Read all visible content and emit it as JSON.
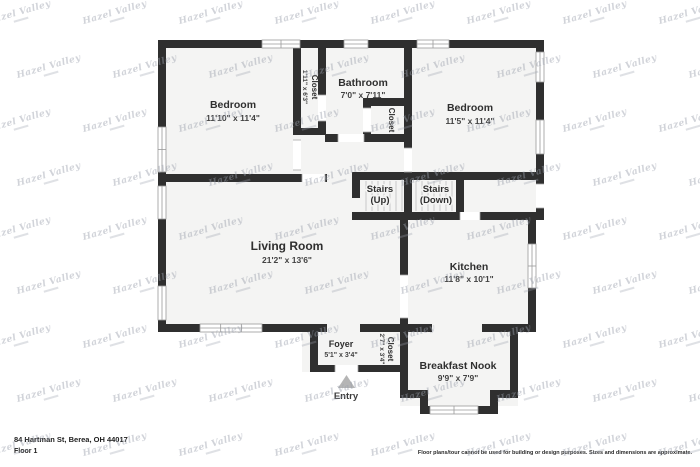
{
  "meta": {
    "watermark": "Hazel Valley"
  },
  "plan": {
    "entry_label": "Entry",
    "rooms": {
      "bedroom1": {
        "name": "Bedroom",
        "dims": "11'10\" x 11'4\""
      },
      "closet1": {
        "name": "Closet",
        "dims": "1'11\" x 6'3\""
      },
      "bathroom": {
        "name": "Bathroom",
        "dims": "7'0\" x 7'11\""
      },
      "closet2": {
        "name": "Closet"
      },
      "bedroom2": {
        "name": "Bedroom",
        "dims": "11'5\" x 11'4\""
      },
      "stairs_up": {
        "name": "Stairs",
        "dims": "(Up)"
      },
      "stairs_down": {
        "name": "Stairs",
        "dims": "(Down)"
      },
      "living": {
        "name": "Living Room",
        "dims": "21'2\" x 13'6\""
      },
      "kitchen": {
        "name": "Kitchen",
        "dims": "11'8\" x 10'1\""
      },
      "foyer": {
        "name": "Foyer",
        "dims": "5'1\" x 3'4\""
      },
      "closet3": {
        "name": "Closet",
        "dims": "2'7\" x 3'4\""
      },
      "nook": {
        "name": "Breakfast Nook",
        "dims": "9'9\" x 7'9\""
      }
    }
  },
  "footer": {
    "address": "84 Hartman St, Berea, OH 44017",
    "floor": "Floor 1",
    "disclaimer": "Floor plans/tour cannot be used for building or design purposes. Sizes and dimensions are approximate."
  },
  "colors": {
    "wall": "#2f2f2f",
    "room_fill": "#f4f4f3",
    "watermark": "#9aa0ac"
  }
}
